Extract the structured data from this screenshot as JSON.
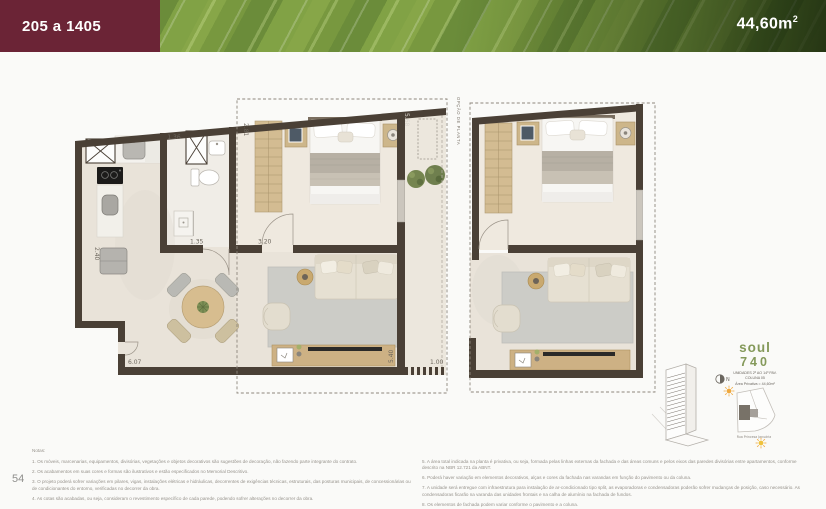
{
  "header": {
    "units_range": "205 a 1405",
    "area_value": "44,60m",
    "area_sup": "2"
  },
  "page_number": "54",
  "plan": {
    "option_label": "OPÇÃO DE PLANTA",
    "dims": {
      "kitchen_width": "1.36",
      "bedroom_depth": "2.81",
      "bathroom_width": "1.35",
      "bedroom_width": "3.20",
      "balcony_length": "5.68",
      "kitchen_depth": "2.40",
      "living_width": "6.07",
      "living_depth": "5.40",
      "balcony_width": "1.00"
    }
  },
  "legend": {
    "logo_top": "soul",
    "logo_bottom": "740",
    "unit_lines": [
      "UNIDADES 2º AO 14º PAV.",
      "COLUNA 05",
      "Área Privativa = 44,60m²"
    ],
    "street": "Rua Princesa Januária",
    "north_label": "N"
  },
  "notes": {
    "heading": "Notas:",
    "left": [
      "1. Os móveis, marcenarias, equipamentos, divisórias, vegetações e objetos decorativos são sugestões de decoração, não fazendo parte integrante do contrato.",
      "2. Os acabamentos em suas cores e formas são ilustrativos e estão especificados no Memorial Descritivo.",
      "3. O projeto poderá sofrer variações em pilares, vigas, instalações elétricas e hidráulicas, decorrentes de exigências técnicas, estruturais, das posturas municipais, de concessionárias ou de condicionantes do entorno, verificadas no decorrer da obra.",
      "4. As cotas são acabadas, ou seja, consideram o revestimento específico de cada parede, podendo sofrer alterações no decorrer da obra."
    ],
    "right": [
      "5. A área total indicada na planta é privativa, ou seja, formada pelas linhas externas da fachada e das áreas comuns e pelos eixos das paredes divisórias entre apartamentos, conforme descrito na NBR 12.721 da ABNT.",
      "6. Poderá haver variação em elementos decorativos, alças e cores da fachada nas varandas em função do pavimento ou da coluna.",
      "7. A unidade será entregue com infraestrutura para instalação de ar-condicionado tipo split, as evaporadoras e condensadoras poderão sofrer mudanças de posição, caso necessário. As condensadoras ficarão na varanda das unidades frontais e na calha de alumínio na fachada de fundos.",
      "8. Os elementos de fachada podem variar conforme o pavimento e a coluna."
    ]
  },
  "colors": {
    "banner_box": "#6b2436",
    "leaf_green": "#78983f",
    "logo_green": "#84995a",
    "wall": "#4a4036",
    "floor": "#e9e3d9",
    "wood": "#cdb68c",
    "sun_orange": "#efa83d"
  }
}
